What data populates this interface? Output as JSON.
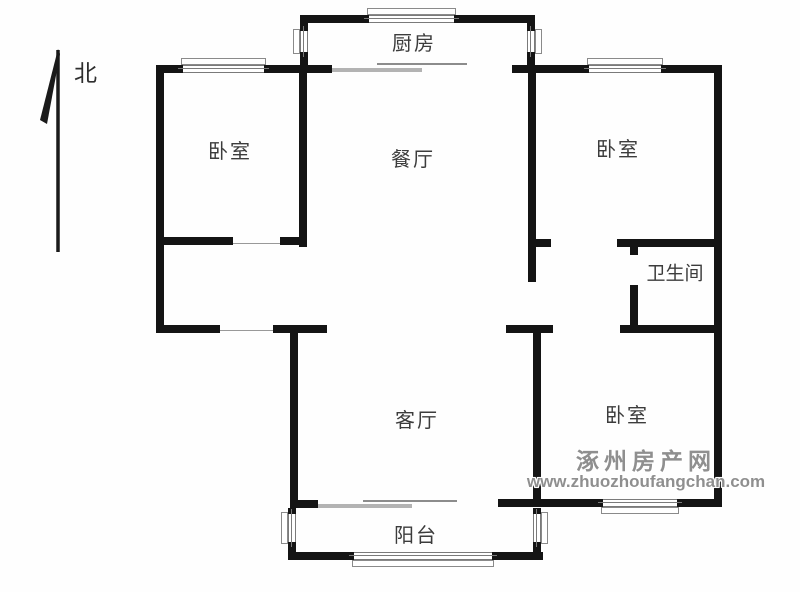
{
  "compass": {
    "label": "北"
  },
  "rooms": {
    "kitchen": {
      "label": "厨房"
    },
    "dining": {
      "label": "餐厅"
    },
    "bedroom_tl": {
      "label": "卧室"
    },
    "bedroom_tr": {
      "label": "卧室"
    },
    "bathroom": {
      "label": "卫生间"
    },
    "living": {
      "label": "客厅"
    },
    "bedroom_br": {
      "label": "卧室"
    },
    "balcony": {
      "label": "阳台"
    }
  },
  "watermark": {
    "site_name": "涿州房产网",
    "site_url": "www.zhuozhoufangchan.com"
  },
  "colors": {
    "wall": "#141414",
    "label": "#3c3c3c",
    "watermark": "#8f8f8f",
    "thin_line": "#999999",
    "slide_dark": "#8c8c8c",
    "slide_light": "#b3b3b3"
  }
}
